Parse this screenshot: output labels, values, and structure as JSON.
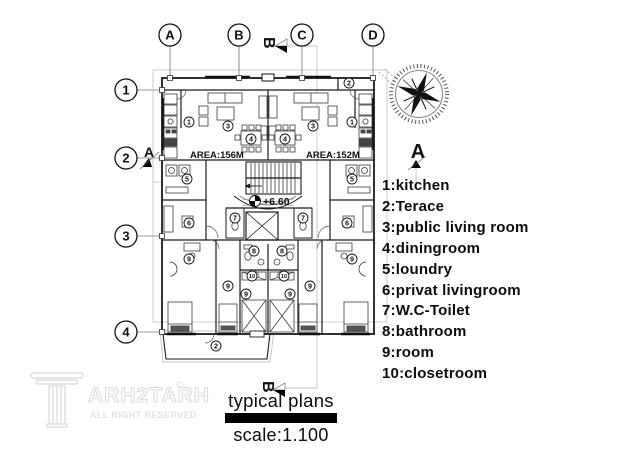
{
  "colors": {
    "ink": "#1b1b1b",
    "furniture_line": "#3a3a3a",
    "faint_line": "#c6c6c6",
    "watermark": "#dcdcdc",
    "title_bar": "#000000"
  },
  "grid": {
    "columns": [
      {
        "label": "A",
        "x": 170
      },
      {
        "label": "B",
        "x": 239
      },
      {
        "label": "C",
        "x": 302
      },
      {
        "label": "D",
        "x": 373
      }
    ],
    "rows": [
      {
        "label": "1",
        "y": 90
      },
      {
        "label": "2",
        "y": 158
      },
      {
        "label": "3",
        "y": 236
      },
      {
        "label": "4",
        "y": 332
      }
    ]
  },
  "plan": {
    "area_left": "AREA:156M",
    "area_right": "AREA:152M",
    "level": "+6.60",
    "room_markers": [
      {
        "n": "2",
        "x": 349,
        "y": 83
      },
      {
        "n": "1",
        "x": 189,
        "y": 122
      },
      {
        "n": "1",
        "x": 352,
        "y": 122
      },
      {
        "n": "3",
        "x": 228,
        "y": 126
      },
      {
        "n": "3",
        "x": 313,
        "y": 126
      },
      {
        "n": "4",
        "x": 251,
        "y": 139
      },
      {
        "n": "4",
        "x": 285,
        "y": 139
      },
      {
        "n": "5",
        "x": 187,
        "y": 179
      },
      {
        "n": "5",
        "x": 352,
        "y": 179
      },
      {
        "n": "6",
        "x": 189,
        "y": 223
      },
      {
        "n": "6",
        "x": 347,
        "y": 223
      },
      {
        "n": "7",
        "x": 235,
        "y": 218
      },
      {
        "n": "7",
        "x": 303,
        "y": 218
      },
      {
        "n": "8",
        "x": 254,
        "y": 251
      },
      {
        "n": "8",
        "x": 282,
        "y": 251
      },
      {
        "n": "9",
        "x": 189,
        "y": 259
      },
      {
        "n": "9",
        "x": 352,
        "y": 259
      },
      {
        "n": "9",
        "x": 228,
        "y": 286
      },
      {
        "n": "9",
        "x": 310,
        "y": 286
      },
      {
        "n": "9",
        "x": 246,
        "y": 294
      },
      {
        "n": "9",
        "x": 290,
        "y": 294
      },
      {
        "n": "10",
        "x": 252,
        "y": 276
      },
      {
        "n": "10",
        "x": 284,
        "y": 276
      },
      {
        "n": "2",
        "x": 216,
        "y": 346
      }
    ]
  },
  "sections": {
    "a_left": "A",
    "a_right": "A",
    "b_top": "B",
    "b_bottom": "B"
  },
  "legend": {
    "items": [
      "1:kitchen",
      "2:Terace",
      "3:public living room",
      "4:diningroom",
      "5:loundry",
      "6:privat livingroom",
      "7:W.C-Toilet",
      "8:bathroom",
      "9:room",
      "10:closetroom"
    ]
  },
  "title_block": {
    "title": "typical plans",
    "scale": "scale:1.100"
  },
  "watermark": {
    "brand": "ARH2TARH",
    "mark": "©",
    "rights": "ALL RIGHT RESERVED"
  }
}
